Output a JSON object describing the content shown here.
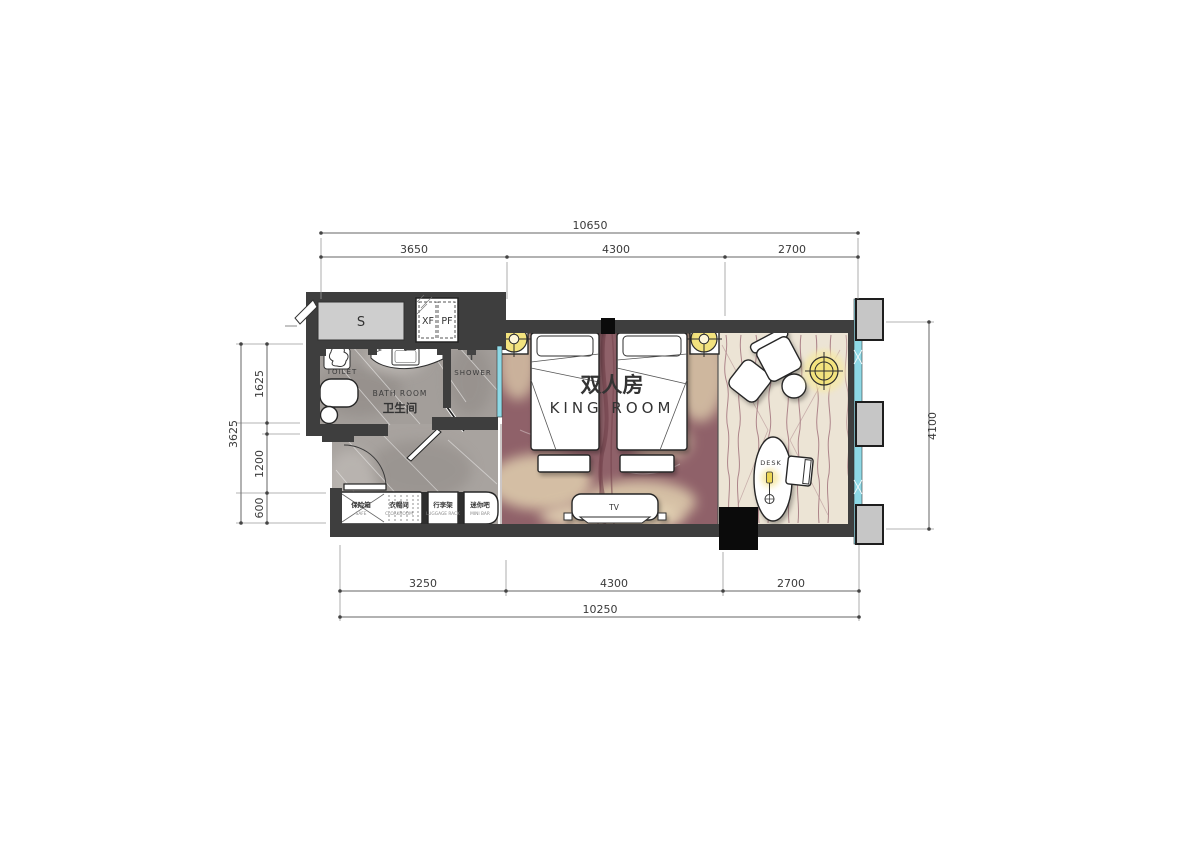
{
  "dimensions": {
    "top": {
      "total": "10650",
      "segments": [
        "3650",
        "4300",
        "2700"
      ]
    },
    "bottom": {
      "total": "10250",
      "segments": [
        "3250",
        "4300",
        "2700"
      ]
    },
    "left": {
      "total": "3625",
      "segments": [
        "1625",
        "1200",
        "600"
      ]
    },
    "right": {
      "total": "4100"
    }
  },
  "rooms": {
    "king_zh": "双人房",
    "king_en": "KING ROOM",
    "bath_zh": "卫生间",
    "bath_en": "BATH ROOM",
    "toilet": "TOILET",
    "shower": "SHOWER",
    "desk": "DESK",
    "tv": "TV",
    "shaft": "S",
    "duct_left": "XF",
    "duct_right": "PF"
  },
  "cabinets": [
    {
      "zh": "保险箱",
      "en": "SAFE"
    },
    {
      "zh": "衣帽间",
      "en": "CLOAKROOM"
    },
    {
      "zh": "行李架",
      "en": "LUGGAGE RACK"
    },
    {
      "zh": "迷你吧",
      "en": "MINI BAR"
    }
  ],
  "colors": {
    "wall": "#3e3e3e",
    "window_glazing": "#8ed9e6",
    "pillar": "#c6c6c6",
    "bath_marble": "#a39e9a",
    "carpet": "#8f6169",
    "carpet_cloud": "#dcc9ab",
    "rug": "#ece4d5",
    "rug_line": "#a3747d",
    "lamp_yellow": "#f3e37e"
  }
}
